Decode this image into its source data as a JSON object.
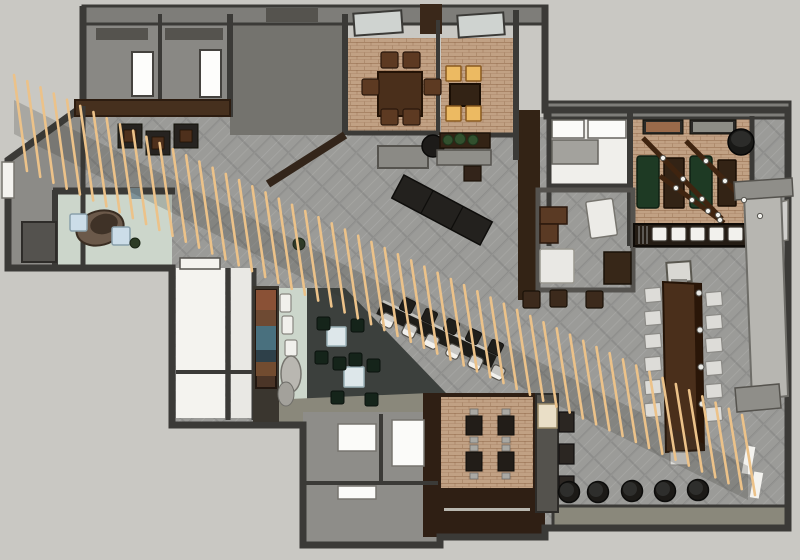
{
  "colors": {
    "exterior": "#c9c8c3",
    "wall_dark": "#3b3a37",
    "wall_mid": "#7e7d79",
    "floor_hatch": "#9b9b98",
    "floor_brick": "#c1a184",
    "floor_mint": "#ccd6cb",
    "floor_charcoal": "#3c403d",
    "floor_white": "#f4f3ef",
    "wood_dark": "#332315",
    "wood_mid": "#4a2f1b",
    "slat": "#ecc289",
    "seat_white": "#f2f1ed",
    "seat_amber": "#ecba62",
    "green_bench": "#1e3a24",
    "black": "#1c1a17",
    "panel": "#b7b6b1",
    "olive": "#8a887b"
  },
  "slat_screen": {
    "count": 56,
    "x0": 14,
    "y0": 75,
    "x1": 742,
    "y1": 415,
    "len0": 96,
    "len1": 80,
    "lean": 13,
    "width": 2.6,
    "fill": "$slat"
  },
  "groups": [
    {
      "name": "hall-tables",
      "shape": "rect",
      "w": 24,
      "h": 24,
      "fill": "#262320",
      "stroke": "#111008",
      "sw": 1,
      "items": [
        [
          118,
          124
        ],
        [
          146,
          131
        ],
        [
          174,
          124
        ]
      ]
    },
    {
      "name": "hall-tables-top",
      "shape": "rect",
      "w": 12,
      "h": 12,
      "fill": "#4e301c",
      "stroke": "#241306",
      "sw": 0.8,
      "items": [
        [
          124,
          130
        ],
        [
          152,
          137
        ],
        [
          180,
          130
        ]
      ]
    },
    {
      "name": "dining-chairs",
      "shape": "rect",
      "w": 17,
      "h": 16,
      "rx": 2,
      "fill": "#5d3a22",
      "stroke": "#2a180c",
      "sw": 1.2,
      "items": [
        [
          381,
          52
        ],
        [
          403,
          52
        ],
        [
          362,
          79
        ],
        [
          424,
          79
        ],
        [
          381,
          109
        ],
        [
          403,
          109
        ]
      ]
    },
    {
      "name": "amber-lit-chairs",
      "shape": "rect",
      "w": 15,
      "h": 15,
      "rx": 1,
      "fill": "$seat_amber",
      "stroke": "#8a5a20",
      "sw": 1.5,
      "items": [
        [
          446,
          66
        ],
        [
          466,
          66
        ],
        [
          446,
          106
        ],
        [
          466,
          106
        ]
      ]
    },
    {
      "name": "lounge-chairs",
      "shape": "rect",
      "w": 13,
      "h": 13,
      "rx": 2,
      "fill": "#15241a",
      "stroke": "#0a120d",
      "sw": 1,
      "items": [
        [
          317,
          317
        ],
        [
          351,
          319
        ],
        [
          315,
          351
        ],
        [
          349,
          353
        ],
        [
          333,
          357
        ],
        [
          367,
          359
        ],
        [
          331,
          391
        ],
        [
          365,
          393
        ]
      ]
    },
    {
      "name": "banquette-cushions",
      "shape": "rect",
      "w": 15,
      "h": 14,
      "rx": 2,
      "fill": "$seat_white",
      "stroke": "#3a352f",
      "sw": 1.2,
      "items": [
        [
          652,
          227
        ],
        [
          671,
          227
        ],
        [
          690,
          227
        ],
        [
          709,
          227
        ],
        [
          728,
          227
        ]
      ]
    },
    {
      "name": "communal-chairs-left",
      "shape": "rect",
      "w": 16,
      "h": 14,
      "rx": 1,
      "rotate": -5,
      "fill": "#dddcd8",
      "stroke": "#8b8a86",
      "sw": 1.2,
      "items": [
        [
          645,
          288
        ],
        [
          645,
          311
        ],
        [
          645,
          334
        ],
        [
          645,
          357
        ],
        [
          645,
          380
        ],
        [
          645,
          403
        ]
      ]
    },
    {
      "name": "communal-chairs-right",
      "shape": "rect",
      "w": 16,
      "h": 14,
      "rx": 1,
      "rotate": -5,
      "fill": "#dddcd8",
      "stroke": "#8b8a86",
      "sw": 1.2,
      "items": [
        [
          706,
          292
        ],
        [
          706,
          315
        ],
        [
          706,
          338
        ],
        [
          706,
          361
        ],
        [
          706,
          384
        ],
        [
          706,
          407
        ]
      ]
    },
    {
      "name": "communal-chair-end",
      "shape": "rect",
      "w": 18,
      "h": 13,
      "rx": 1,
      "fill": "#dddcd8",
      "stroke": "#8b8a86",
      "sw": 1.2,
      "items": [
        [
          670,
          452
        ]
      ]
    },
    {
      "name": "bar-stools-white",
      "shape": "rect",
      "w": 13,
      "h": 13,
      "rx": 3,
      "rotate": 26,
      "fill": "$seat_white",
      "stroke": "#55524c",
      "sw": 1.2,
      "items": [
        [
          381,
          314
        ],
        [
          403,
          324
        ],
        [
          425,
          335
        ],
        [
          447,
          345
        ],
        [
          469,
          356
        ],
        [
          491,
          366
        ]
      ]
    },
    {
      "name": "bar-stools-dark",
      "shape": "rect",
      "w": 13,
      "h": 13,
      "rx": 2,
      "rotate": 26,
      "fill": "#1c1a17",
      "stroke": "#0c0b09",
      "sw": 1,
      "items": [
        [
          401,
          299
        ],
        [
          423,
          310
        ],
        [
          445,
          320
        ],
        [
          467,
          330
        ],
        [
          489,
          341
        ]
      ]
    },
    {
      "name": "terrace-tables",
      "shape": "rect",
      "w": 16,
      "h": 19,
      "fill": "#221d18",
      "stroke": "#0f0d0a",
      "sw": 1,
      "items": [
        [
          466,
          416
        ],
        [
          498,
          416
        ],
        [
          466,
          452
        ],
        [
          498,
          452
        ]
      ]
    },
    {
      "name": "terrace-chair-nubs",
      "shape": "rect",
      "w": 8,
      "h": 6,
      "fill": "#a9a8a3",
      "stroke": "#6e6d68",
      "sw": 0.8,
      "items": [
        [
          470,
          409
        ],
        [
          502,
          409
        ],
        [
          470,
          437
        ],
        [
          502,
          437
        ],
        [
          470,
          445
        ],
        [
          502,
          445
        ],
        [
          470,
          473
        ],
        [
          502,
          473
        ]
      ]
    },
    {
      "name": "office-stools",
      "shape": "rect",
      "w": 17,
      "h": 17,
      "rx": 2,
      "fill": "#3c2a1c",
      "stroke": "#1a1208",
      "sw": 1.2,
      "items": [
        [
          523,
          291
        ],
        [
          550,
          290
        ],
        [
          586,
          291
        ]
      ]
    },
    {
      "name": "poufs",
      "shape": "circle",
      "r": 10.5,
      "fill": "#1c1a17",
      "stroke": "#0c0c0b",
      "sw": 1.5,
      "items": [
        [
          569,
          492
        ],
        [
          598,
          492
        ],
        [
          632,
          491
        ],
        [
          665,
          491
        ],
        [
          698,
          490
        ]
      ]
    },
    {
      "name": "pouf-tops",
      "shape": "circle",
      "r": 7,
      "fill": "#2e2e2c",
      "stroke": "none",
      "sw": 0,
      "items": [
        [
          567,
          490
        ],
        [
          596,
          490
        ],
        [
          630,
          489
        ],
        [
          663,
          489
        ],
        [
          696,
          488
        ]
      ]
    },
    {
      "name": "beam-lights",
      "shape": "circle",
      "r": 2.6,
      "fill": "#f2f2ee",
      "stroke": "#55534e",
      "sw": 1,
      "items": [
        [
          663,
          158
        ],
        [
          683,
          179
        ],
        [
          702,
          199
        ],
        [
          718,
          215
        ],
        [
          706,
          161
        ],
        [
          725,
          181
        ],
        [
          744,
          200
        ],
        [
          760,
          216
        ],
        [
          676,
          188
        ],
        [
          692,
          200
        ],
        [
          708,
          211
        ],
        [
          720,
          220
        ]
      ]
    },
    {
      "name": "table-clamps",
      "shape": "circle",
      "r": 3,
      "fill": "#e8e8e4",
      "stroke": "#55534e",
      "sw": 1,
      "items": [
        [
          699,
          293
        ],
        [
          700,
          330
        ],
        [
          701,
          367
        ],
        [
          702,
          404
        ]
      ]
    }
  ]
}
